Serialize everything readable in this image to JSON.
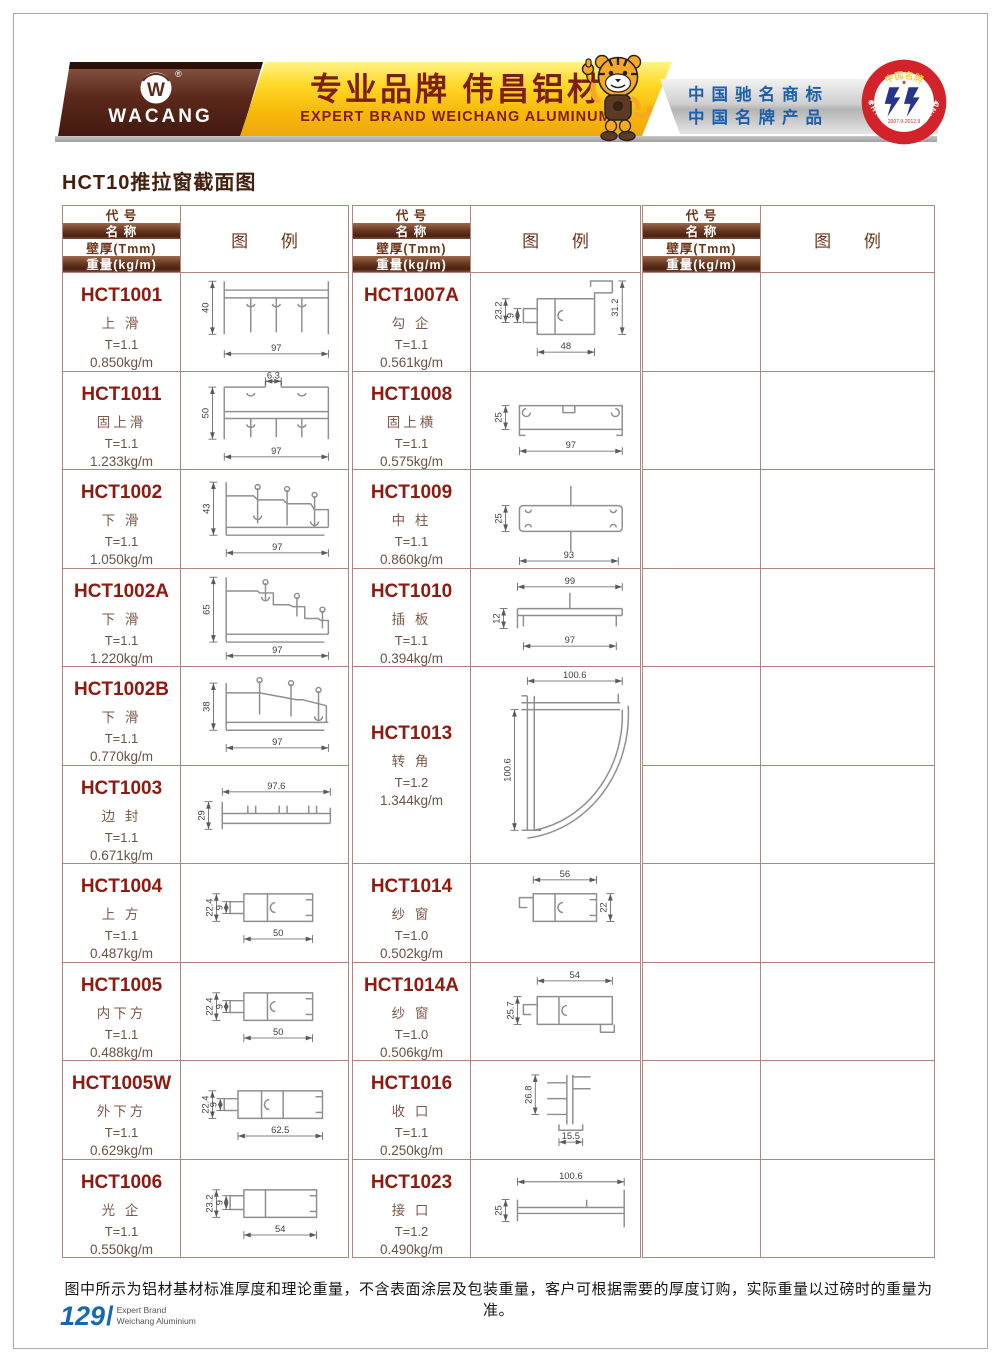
{
  "header": {
    "logo_text": "WACANG",
    "registered_mark": "®",
    "banner_title_cn": "专业品牌  伟昌铝材",
    "banner_title_en": "EXPERT BRAND WEICHANG ALUMINUM",
    "badge_line1": "中国驰名商标",
    "badge_line2": "中国名牌产品",
    "seal_top": "中国名牌",
    "seal_bottom": "CHINA TOP BRAND",
    "seal_dates": "2007.9-2012.9"
  },
  "page_title": "HCT10推拉窗截面图",
  "table": {
    "header_rows": [
      "代  号",
      "名  称",
      "壁厚(Tmm)",
      "重量(kg/m)"
    ],
    "legend_label": "图  例",
    "groups": [
      {
        "rows": [
          {
            "code": "HCT1001",
            "name": "上 滑",
            "thickness": "T=1.1",
            "weight": "0.850kg/m",
            "drawing": "d1001",
            "dims": [
              "40",
              "97"
            ]
          },
          {
            "code": "HCT1011",
            "name": "固上滑",
            "thickness": "T=1.1",
            "weight": "1.233kg/m",
            "drawing": "d1011",
            "dims": [
              "6.3",
              "50",
              "97"
            ]
          },
          {
            "code": "HCT1002",
            "name": "下 滑",
            "thickness": "T=1.1",
            "weight": "1.050kg/m",
            "drawing": "d1002",
            "dims": [
              "43",
              "97"
            ]
          },
          {
            "code": "HCT1002A",
            "name": "下 滑",
            "thickness": "T=1.1",
            "weight": "1.220kg/m",
            "drawing": "d1002a",
            "dims": [
              "65",
              "97"
            ]
          },
          {
            "code": "HCT1002B",
            "name": "下 滑",
            "thickness": "T=1.1",
            "weight": "0.770kg/m",
            "drawing": "d1002b",
            "dims": [
              "38",
              "97"
            ]
          },
          {
            "code": "HCT1003",
            "name": "边 封",
            "thickness": "T=1.1",
            "weight": "0.671kg/m",
            "drawing": "d1003",
            "dims": [
              "97.6",
              "29"
            ]
          },
          {
            "code": "HCT1004",
            "name": "上 方",
            "thickness": "T=1.1",
            "weight": "0.487kg/m",
            "drawing": "d1004",
            "dims": [
              "22.4",
              "9",
              "50"
            ]
          },
          {
            "code": "HCT1005",
            "name": "内下方",
            "thickness": "T=1.1",
            "weight": "0.488kg/m",
            "drawing": "d1004",
            "dims": [
              "22.4",
              "9",
              "50"
            ]
          },
          {
            "code": "HCT1005W",
            "name": "外下方",
            "thickness": "T=1.1",
            "weight": "0.629kg/m",
            "drawing": "d1005w",
            "dims": [
              "22.4",
              "9",
              "62.5"
            ]
          },
          {
            "code": "HCT1006",
            "name": "光 企",
            "thickness": "T=1.1",
            "weight": "0.550kg/m",
            "drawing": "d1006",
            "dims": [
              "23.2",
              "9",
              "54"
            ]
          }
        ]
      },
      {
        "rows": [
          {
            "code": "HCT1007A",
            "name": "勾 企",
            "thickness": "T=1.1",
            "weight": "0.561kg/m",
            "drawing": "d1007a",
            "dims": [
              "23.2",
              "9",
              "31.2",
              "48"
            ]
          },
          {
            "code": "HCT1008",
            "name": "固上横",
            "thickness": "T=1.1",
            "weight": "0.575kg/m",
            "drawing": "d1008",
            "dims": [
              "25",
              "97"
            ]
          },
          {
            "code": "HCT1009",
            "name": "中 柱",
            "thickness": "T=1.1",
            "weight": "0.860kg/m",
            "drawing": "d1009",
            "dims": [
              "25",
              "93"
            ]
          },
          {
            "code": "HCT1010",
            "name": "插 板",
            "thickness": "T=1.1",
            "weight": "0.394kg/m",
            "drawing": "d1010",
            "dims": [
              "99",
              "12",
              "97"
            ]
          },
          {
            "code": "HCT1013",
            "name": "转 角",
            "thickness": "T=1.2",
            "weight": "1.344kg/m",
            "drawing": "d1013",
            "dims": [
              "100.6",
              "100.6"
            ],
            "tall": true
          },
          {
            "code": "HCT1014",
            "name": "纱 窗",
            "thickness": "T=1.0",
            "weight": "0.502kg/m",
            "drawing": "d1014",
            "dims": [
              "56",
              "22"
            ]
          },
          {
            "code": "HCT1014A",
            "name": "纱 窗",
            "thickness": "T=1.0",
            "weight": "0.506kg/m",
            "drawing": "d1014a",
            "dims": [
              "54",
              "25.7"
            ]
          },
          {
            "code": "HCT1016",
            "name": "收 口",
            "thickness": "T=1.1",
            "weight": "0.250kg/m",
            "drawing": "d1016",
            "dims": [
              "26.8",
              "15.5"
            ]
          },
          {
            "code": "HCT1023",
            "name": "接 口",
            "thickness": "T=1.2",
            "weight": "0.490kg/m",
            "drawing": "d1023",
            "dims": [
              "100.6",
              "25"
            ]
          }
        ]
      },
      {
        "rows": [],
        "empty_row_count": 10
      }
    ]
  },
  "footer": {
    "note": "图中所示为铝材基材标准厚度和理论重量，不含表面涂层及包装重量，客户可根据需要的厚度订购，实际重量以过磅时的重量为准。",
    "page_number": "129",
    "page_suffix": "/",
    "brand_line1": "Expert Brand",
    "brand_line2": "Weichang Aluminium"
  }
}
